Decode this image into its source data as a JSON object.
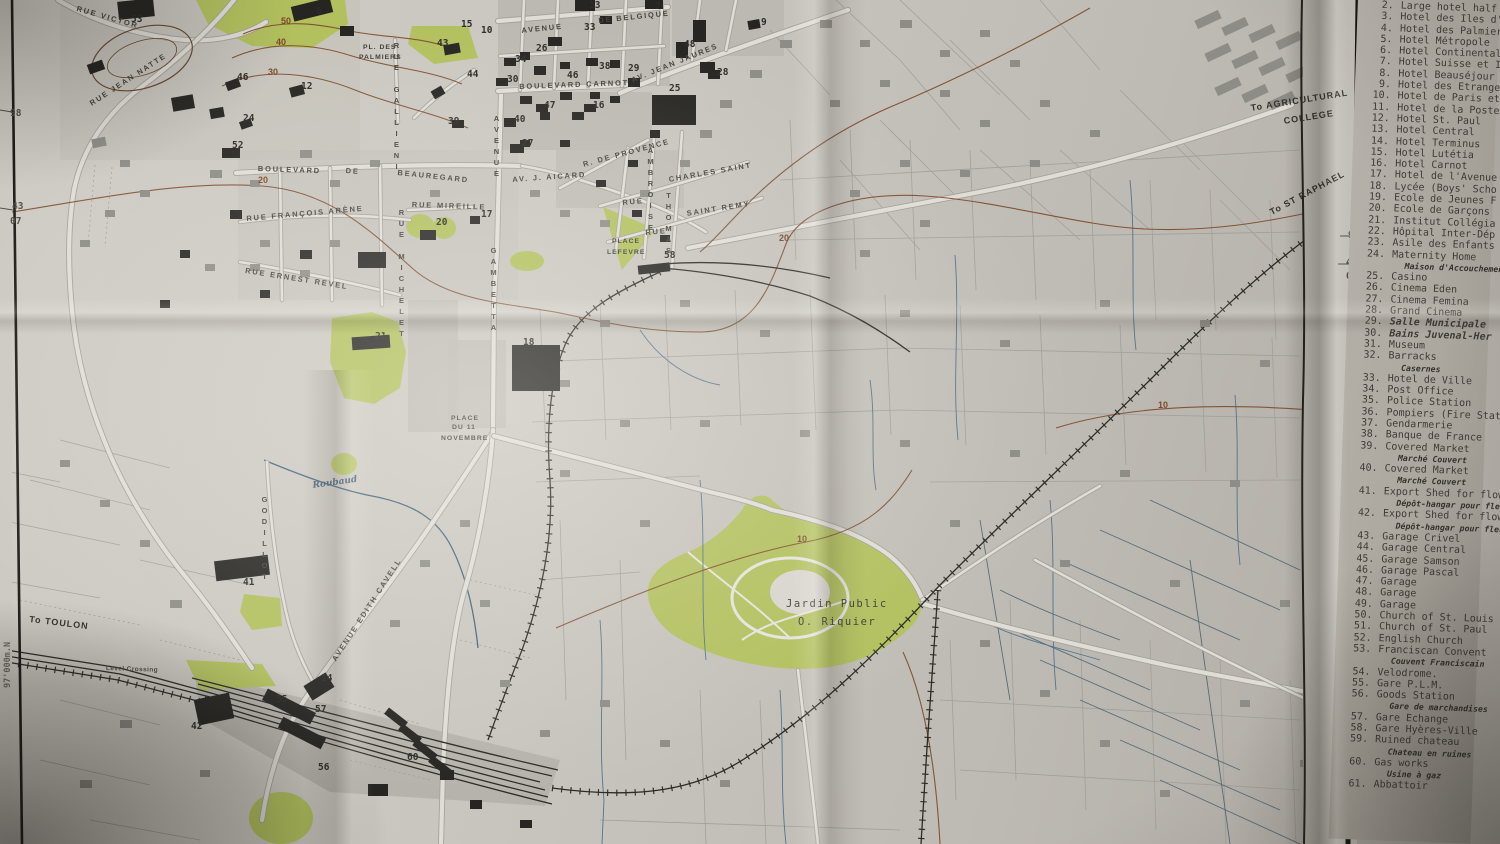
{
  "colors": {
    "paper": "#c9c6bf",
    "park_green": "#b2c05e",
    "contour_brown": "#7c4a28",
    "water_blue": "#54748c",
    "building_dark": "#262522",
    "legend_paper": "#aca89f"
  },
  "legend": {
    "items": [
      {
        "n": "2.",
        "t": "Large hotel half b"
      },
      {
        "n": "3.",
        "t": "Hotel des Iles d'O"
      },
      {
        "n": "4.",
        "t": "Hotel des Palmiers"
      },
      {
        "n": "5.",
        "t": "Hotel Métropole"
      },
      {
        "n": "6.",
        "t": "Hotel Continental"
      },
      {
        "n": "7.",
        "t": "Hotel Suisse et Il"
      },
      {
        "n": "8.",
        "t": "Hotel Beauséjour"
      },
      {
        "n": "9.",
        "t": "Hotel des Etrangers"
      },
      {
        "n": "10.",
        "t": "Hotel de Paris et"
      },
      {
        "n": "11.",
        "t": "Hotel de la Poste"
      },
      {
        "n": "12.",
        "t": "Hotel St. Paul"
      },
      {
        "n": "13.",
        "t": "Hotel Central"
      },
      {
        "n": "14.",
        "t": "Hotel Terminus"
      },
      {
        "n": "15.",
        "t": "Hotel Lutétia"
      },
      {
        "n": "16.",
        "t": "Hotel Carnot"
      },
      {
        "n": "17.",
        "t": "Hotel de l'Avenue"
      },
      {
        "n": "18.",
        "t": "Lycée (Boys' Scho"
      },
      {
        "n": "19.",
        "t": "Ecole de Jeunes F"
      },
      {
        "n": "20.",
        "t": "Ecole de Garçons"
      },
      {
        "n": "21.",
        "t": "Institut Collégia"
      },
      {
        "n": "22.",
        "t": "Hôpital Inter-Dép"
      },
      {
        "n": "23.",
        "t": "Asile des Enfants"
      },
      {
        "n": "24.",
        "t": "Maternity Home",
        "s": "Maison d'Accouchement"
      },
      {
        "n": "25.",
        "t": "Casino"
      },
      {
        "n": "26.",
        "t": "Cinema Eden"
      },
      {
        "n": "27.",
        "t": "Cinema Femina"
      },
      {
        "n": "28.",
        "t": "Grand Cinema"
      },
      {
        "n": "29.",
        "t": "Salle Municipale",
        "it": true
      },
      {
        "n": "30.",
        "t": "Bains Juvenal-Her",
        "it": true
      },
      {
        "n": "31.",
        "t": "Museum"
      },
      {
        "n": "32.",
        "t": "Barracks",
        "s": "Casernes"
      },
      {
        "n": "33.",
        "t": "Hotel de Ville"
      },
      {
        "n": "34.",
        "t": "Post Office"
      },
      {
        "n": "35.",
        "t": "Police Station"
      },
      {
        "n": "36.",
        "t": "Pompiers (Fire Stat"
      },
      {
        "n": "37.",
        "t": "Gendarmerie"
      },
      {
        "n": "38.",
        "t": "Banque de France"
      },
      {
        "n": "39.",
        "t": "Covered Market",
        "s": "Marché Couvert"
      },
      {
        "n": "40.",
        "t": "Covered Market",
        "s": "Marché Couvert"
      },
      {
        "n": "41.",
        "t": "Export Shed for flowe",
        "s": "Dépôt-hangar pour fleurs et"
      },
      {
        "n": "42.",
        "t": "Export Shed for flowe",
        "s": "Dépôt-hangar pour fleurs et"
      },
      {
        "n": "43.",
        "t": "Garage Crivel"
      },
      {
        "n": "44.",
        "t": "Garage Central"
      },
      {
        "n": "45.",
        "t": "Garage Samson"
      },
      {
        "n": "46.",
        "t": "Garage Pascal"
      },
      {
        "n": "47.",
        "t": "Garage"
      },
      {
        "n": "48.",
        "t": "Garage"
      },
      {
        "n": "49.",
        "t": "Garage"
      },
      {
        "n": "50.",
        "t": "Church of St. Louis"
      },
      {
        "n": "51.",
        "t": "Church of St. Paul"
      },
      {
        "n": "52.",
        "t": "English Church"
      },
      {
        "n": "53.",
        "t": "Franciscan Convent",
        "s": "Couvent Franciscain"
      },
      {
        "n": "54.",
        "t": "Velodrome."
      },
      {
        "n": "55.",
        "t": "Gare P.L.M."
      },
      {
        "n": "56.",
        "t": "Goods Station",
        "s": "Gare de marchandises"
      },
      {
        "n": "57.",
        "t": "Gare Echange"
      },
      {
        "n": "58.",
        "t": "Gare Hyères-Ville"
      },
      {
        "n": "59.",
        "t": "Ruined chateau",
        "s": "Chateau en ruines"
      },
      {
        "n": "60.",
        "t": "Gas works",
        "s": "Usine à gaz"
      },
      {
        "n": "61.",
        "t": "Abbattoir"
      }
    ]
  },
  "map": {
    "labels": [
      {
        "t": "RUE VICTOR",
        "x": 78,
        "y": 4,
        "r": 16,
        "k": "st"
      },
      {
        "t": "RUE JEAN NATTE",
        "x": 88,
        "y": 100,
        "r": -33,
        "k": "st"
      },
      {
        "t": "BOULEVARD",
        "x": 258,
        "y": 164,
        "r": 2,
        "k": "st"
      },
      {
        "t": "DE",
        "x": 346,
        "y": 166,
        "r": 4,
        "k": "st"
      },
      {
        "t": "BEAUREGARD",
        "x": 398,
        "y": 168,
        "r": 6,
        "k": "st"
      },
      {
        "t": "RUE FRANÇOIS ARÈNE",
        "x": 246,
        "y": 214,
        "r": -5,
        "k": "st"
      },
      {
        "t": "RUE ERNEST REVEL",
        "x": 246,
        "y": 266,
        "r": 9,
        "k": "st"
      },
      {
        "t": "RUE MIREILLE",
        "x": 412,
        "y": 200,
        "r": 2,
        "k": "st"
      },
      {
        "t": "AV. J. AICARD",
        "x": 512,
        "y": 175,
        "r": -4,
        "k": "st"
      },
      {
        "t": "R. DE PROVENCE",
        "x": 582,
        "y": 160,
        "r": -15,
        "k": "st"
      },
      {
        "t": "BOULEVARD CARNOT",
        "x": 519,
        "y": 82,
        "r": -2,
        "k": "st"
      },
      {
        "t": "AVENUE",
        "x": 521,
        "y": 26,
        "r": -6,
        "k": "st"
      },
      {
        "t": "DE BELGIQUE",
        "x": 598,
        "y": 16,
        "r": -6,
        "k": "st"
      },
      {
        "t": "AV. JEAN JAURES",
        "x": 630,
        "y": 76,
        "r": -22,
        "k": "st"
      },
      {
        "t": "CHARLES SAINT",
        "x": 668,
        "y": 175,
        "r": -10,
        "k": "st"
      },
      {
        "t": "SAINT REMY",
        "x": 686,
        "y": 209,
        "r": -9,
        "k": "st"
      },
      {
        "t": "RUE",
        "x": 622,
        "y": 198,
        "r": -5,
        "k": "st"
      },
      {
        "t": "RUE",
        "x": 645,
        "y": 228,
        "r": -5,
        "k": "st"
      },
      {
        "t": "AVENUE EDITH CAVELL",
        "x": 330,
        "y": 658,
        "r": -57,
        "k": "st"
      },
      {
        "t": "PL. DES",
        "x": 363,
        "y": 44,
        "r": 0,
        "k": "pl"
      },
      {
        "t": "PALMIERS",
        "x": 359,
        "y": 54,
        "r": 0,
        "k": "pl"
      },
      {
        "t": "PLACE",
        "x": 612,
        "y": 238,
        "r": 0,
        "k": "pl"
      },
      {
        "t": "LEFEVRE",
        "x": 607,
        "y": 249,
        "r": 0,
        "k": "pl"
      },
      {
        "t": "PLACE",
        "x": 451,
        "y": 415,
        "r": 0,
        "k": "pl"
      },
      {
        "t": "DU 11",
        "x": 452,
        "y": 424,
        "r": 0,
        "k": "pl"
      },
      {
        "t": "NOVEMBRE",
        "x": 441,
        "y": 435,
        "r": 0,
        "k": "pl"
      },
      {
        "t": "To TOULON",
        "x": 30,
        "y": 614,
        "r": 7,
        "k": "dest"
      },
      {
        "t": "Level Crossing",
        "x": 106,
        "y": 665,
        "r": 2,
        "k": "lc"
      },
      {
        "t": "To AGRICULTURAL",
        "x": 1250,
        "y": 103,
        "r": -9,
        "k": "dest"
      },
      {
        "t": "COLLEGE",
        "x": 1283,
        "y": 116,
        "r": -9,
        "k": "dest"
      },
      {
        "t": "To ST RAPHAEL",
        "x": 1268,
        "y": 208,
        "r": -28,
        "k": "dest"
      },
      {
        "t": "Jardin Public",
        "x": 786,
        "y": 598,
        "r": 0,
        "k": "park"
      },
      {
        "t": "O. Riquier",
        "x": 798,
        "y": 616,
        "r": 0,
        "k": "park"
      },
      {
        "t": "Roubaud",
        "x": 312,
        "y": 481,
        "r": -8,
        "k": "w"
      },
      {
        "t": "AVENUE",
        "x": 492,
        "y": 114,
        "r": 0,
        "k": "stv"
      },
      {
        "t": "GAMBETTA",
        "x": 489,
        "y": 246,
        "r": 0,
        "k": "stv"
      },
      {
        "t": "RUE MICHELET",
        "x": 397,
        "y": 208,
        "r": 0,
        "k": "stv"
      },
      {
        "t": "AMBROISE",
        "x": 646,
        "y": 146,
        "r": 0,
        "k": "stv"
      },
      {
        "t": "THOMAS",
        "x": 664,
        "y": 191,
        "r": 0,
        "k": "stv"
      },
      {
        "t": "RUE GALLIENI",
        "x": 392,
        "y": 41,
        "r": 0,
        "k": "stv"
      },
      {
        "t": "GODILLOT",
        "x": 260,
        "y": 495,
        "r": 0,
        "k": "stv"
      },
      {
        "t": "98",
        "x": 10,
        "y": 108,
        "r": 0,
        "k": "g"
      },
      {
        "t": "43",
        "x": 12,
        "y": 201,
        "r": 0,
        "k": "g"
      },
      {
        "t": "07",
        "x": 10,
        "y": 216,
        "r": 0,
        "k": "g"
      },
      {
        "t": "98",
        "x": 1348,
        "y": 230,
        "r": 0,
        "k": "g"
      },
      {
        "t": "43",
        "x": 1346,
        "y": 257,
        "r": 0,
        "k": "g"
      },
      {
        "t": "07",
        "x": 1346,
        "y": 271,
        "r": 0,
        "k": "g"
      },
      {
        "t": "97'000m.N",
        "x": 3,
        "y": 688,
        "r": 0,
        "k": "gv"
      },
      {
        "t": "97'000m.N",
        "x": 1334,
        "y": 832,
        "r": 0,
        "k": "gv"
      }
    ],
    "numbers": [
      {
        "t": "53",
        "x": 131,
        "y": 14
      },
      {
        "t": "6",
        "x": 316,
        "y": 6
      },
      {
        "t": "13",
        "x": 589,
        "y": 0
      },
      {
        "t": "7",
        "x": 655,
        "y": 1
      },
      {
        "t": "9",
        "x": 761,
        "y": 17
      },
      {
        "t": "33",
        "x": 584,
        "y": 22
      },
      {
        "t": "10",
        "x": 481,
        "y": 25
      },
      {
        "t": "15",
        "x": 461,
        "y": 19
      },
      {
        "t": "43",
        "x": 437,
        "y": 38
      },
      {
        "t": "26",
        "x": 536,
        "y": 43
      },
      {
        "t": "34",
        "x": 515,
        "y": 54
      },
      {
        "t": "48",
        "x": 684,
        "y": 39
      },
      {
        "t": "46",
        "x": 567,
        "y": 70
      },
      {
        "t": "38",
        "x": 599,
        "y": 61
      },
      {
        "t": "29",
        "x": 628,
        "y": 63
      },
      {
        "t": "28",
        "x": 717,
        "y": 67
      },
      {
        "t": "44",
        "x": 467,
        "y": 69
      },
      {
        "t": "46",
        "x": 237,
        "y": 72
      },
      {
        "t": "30",
        "x": 507,
        "y": 74
      },
      {
        "t": "12",
        "x": 301,
        "y": 81
      },
      {
        "t": "25",
        "x": 669,
        "y": 83
      },
      {
        "t": "47",
        "x": 544,
        "y": 100
      },
      {
        "t": "16",
        "x": 593,
        "y": 100
      },
      {
        "t": "40",
        "x": 514,
        "y": 114
      },
      {
        "t": "39",
        "x": 448,
        "y": 116
      },
      {
        "t": "24",
        "x": 243,
        "y": 113
      },
      {
        "t": "27",
        "x": 522,
        "y": 138
      },
      {
        "t": "52",
        "x": 232,
        "y": 140
      },
      {
        "t": "17",
        "x": 481,
        "y": 209
      },
      {
        "t": "20",
        "x": 436,
        "y": 217
      },
      {
        "t": "21",
        "x": 375,
        "y": 331
      },
      {
        "t": "18",
        "x": 523,
        "y": 337
      },
      {
        "t": "58",
        "x": 664,
        "y": 250
      },
      {
        "t": "41",
        "x": 243,
        "y": 577
      },
      {
        "t": "42",
        "x": 191,
        "y": 721
      },
      {
        "t": "55",
        "x": 276,
        "y": 694
      },
      {
        "t": "57",
        "x": 315,
        "y": 704
      },
      {
        "t": "56",
        "x": 318,
        "y": 762
      },
      {
        "t": "60",
        "x": 407,
        "y": 752
      },
      {
        "t": "14",
        "x": 321,
        "y": 673
      }
    ],
    "contour_labels": [
      {
        "t": "50",
        "x": 281,
        "y": 16
      },
      {
        "t": "40",
        "x": 276,
        "y": 37
      },
      {
        "t": "30",
        "x": 268,
        "y": 67
      },
      {
        "t": "20",
        "x": 258,
        "y": 175
      },
      {
        "t": "20",
        "x": 779,
        "y": 233
      },
      {
        "t": "10",
        "x": 797,
        "y": 534
      },
      {
        "t": "10",
        "x": 1158,
        "y": 400
      }
    ]
  }
}
